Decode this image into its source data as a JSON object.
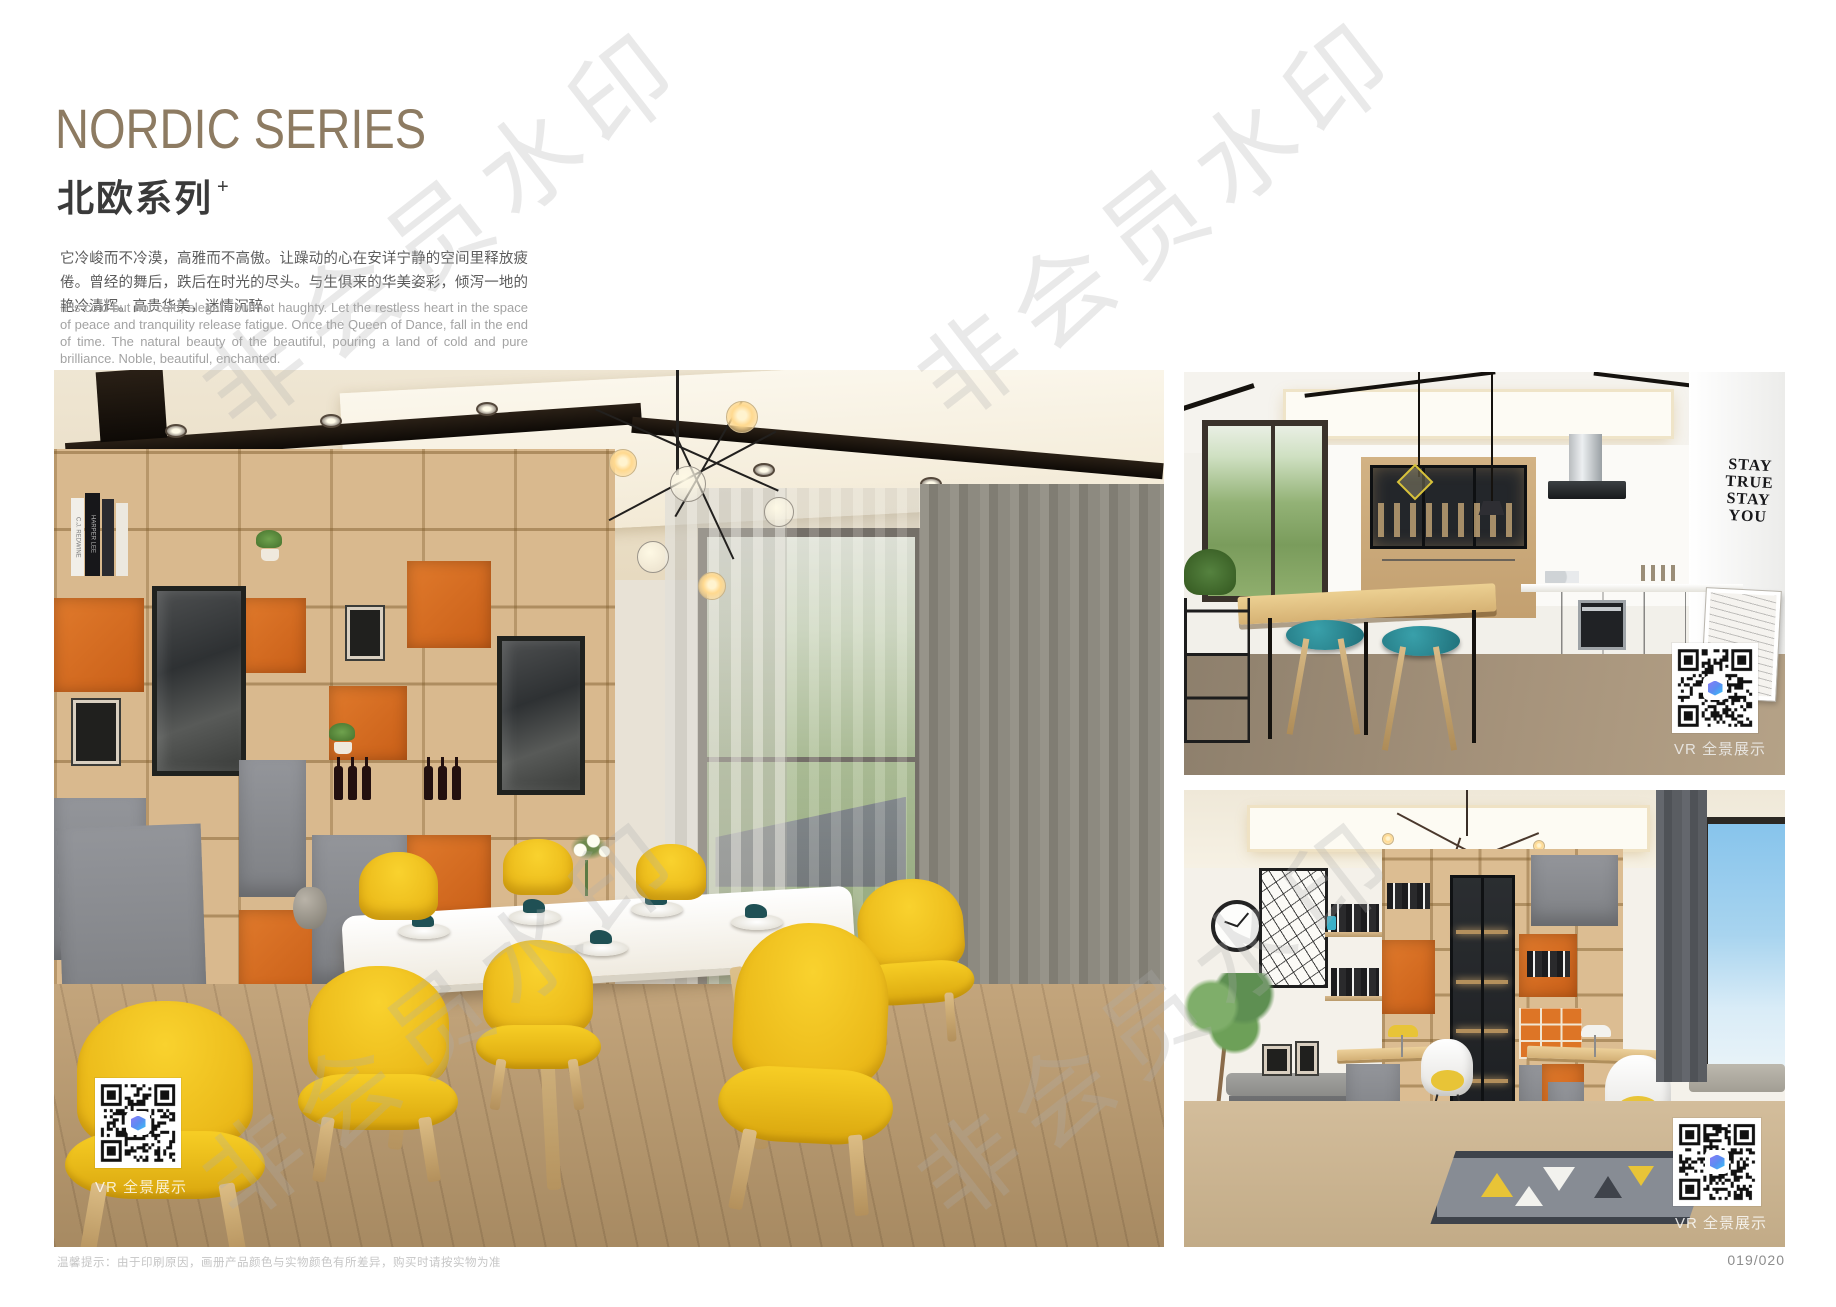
{
  "header": {
    "title": "NORDIC SERIES",
    "subtitle_cn": "北欧系列",
    "subtitle_plus": "+",
    "paragraph_cn": "它冷峻而不冷漠，高雅而不高傲。让躁动的心在安详宁静的空间里释放疲倦。曾经的舞后，跌后在时光的尽头。与生俱来的华美姿彩，倾泻一地的艳冷清辉。高贵华美，迷情沉醉。",
    "paragraph_en": "It is cold but not cold, elegant but not haughty. Let the restless heart in the space of peace and tranquility release fatigue. Once the Queen of Dance, fall in the end of time. The natural beauty of the beautiful, pouring a land of cold and pure brilliance. Noble, beautiful, enchanted."
  },
  "footer": {
    "note": "温馨提示：由于印刷原因，画册产品颜色与实物颜色有所差异，购买时请按实物为准",
    "page_number": "019/020"
  },
  "watermark": {
    "text": "非会员水印"
  },
  "photos": {
    "dining": {
      "vr_label": "VR 全景展示",
      "book_spines": [
        "C.J. REDWINE",
        "HARPER LEE"
      ]
    },
    "kitchen": {
      "vr_label": "VR 全景展示",
      "wall_decal": [
        "STAY",
        "TRUE",
        "STAY",
        "YOU"
      ]
    },
    "study": {
      "vr_label": "VR 全景展示"
    }
  },
  "colors": {
    "title_brown": "#8d7b62",
    "accent_orange": "#dd7226",
    "chair_yellow": "#f2c51f",
    "stool_teal": "#2d8b95",
    "cabinet_gray": "#85888c"
  }
}
